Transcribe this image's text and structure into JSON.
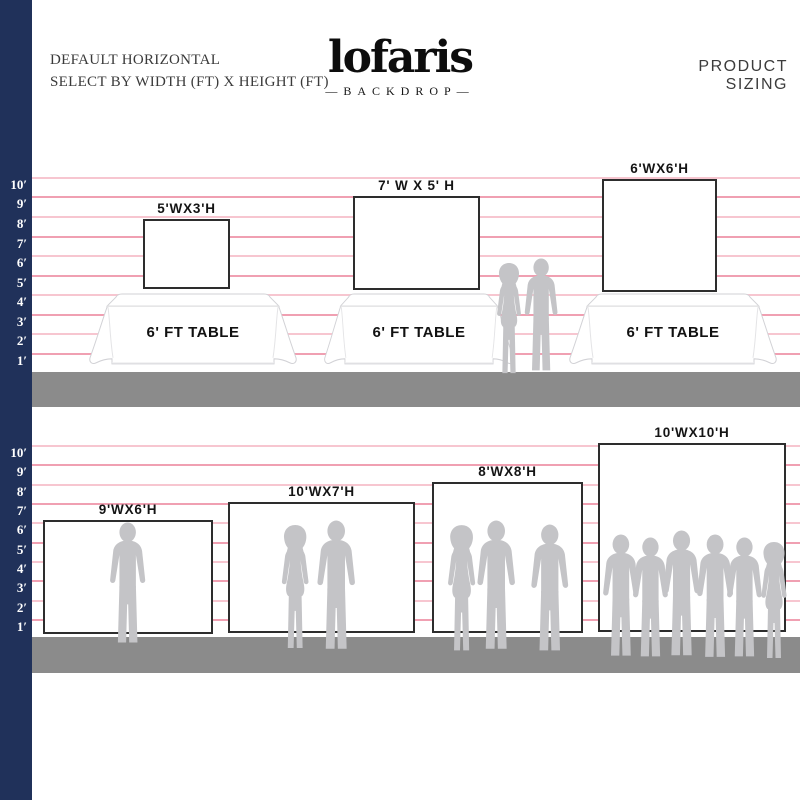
{
  "header": {
    "note_line1": "DEFAULT HORIZONTAL",
    "note_line2": "SELECT BY WIDTH (FT) X HEIGHT (FT)",
    "brand_name": "lofaris",
    "brand_sub": "—BACKDROP—",
    "page_title": "PRODUCT SIZING"
  },
  "ruler": {
    "labels": [
      "10′",
      "9′",
      "8′",
      "7′",
      "6′",
      "5′",
      "4′",
      "3′",
      "2′",
      "1′"
    ]
  },
  "sections": {
    "top": {
      "backdrops": [
        {
          "label": "5'WX3'H"
        },
        {
          "label": "7' W X 5' H"
        },
        {
          "label": "6'WX6'H"
        }
      ],
      "tables": [
        {
          "label": "6' FT TABLE"
        },
        {
          "label": "6' FT TABLE"
        },
        {
          "label": "6' FT TABLE"
        }
      ]
    },
    "bottom": {
      "backdrops": [
        {
          "label": "9'WX6'H"
        },
        {
          "label": "10'WX7'H"
        },
        {
          "label": "8'WX8'H"
        },
        {
          "label": "10'WX10'H"
        }
      ]
    }
  },
  "colors": {
    "navy": "#20315a",
    "line_pink": "#f0a0b2",
    "line_pink_light": "#f7c6d0",
    "floor": "#8b8b8b",
    "silhouette": "#c4c4c7",
    "border": "#2d2d2d"
  }
}
